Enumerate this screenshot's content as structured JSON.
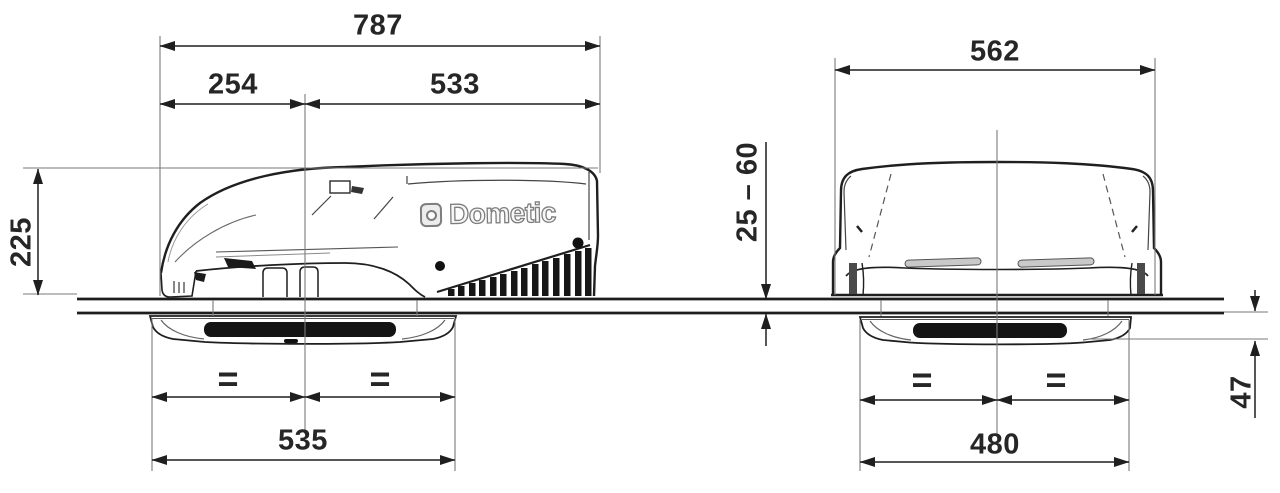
{
  "drawing_title": "rooftop-air-conditioner-dimensional-drawing",
  "logo": {
    "brand": "Dometic"
  },
  "symbols": {
    "equals": "="
  },
  "side_view": {
    "dimensions": {
      "overall_length": "787",
      "front_to_opening_center": "254",
      "opening_center_to_rear": "533",
      "height_above_roof": "225",
      "interior_unit_length": "535"
    }
  },
  "front_view": {
    "dimensions": {
      "overall_width": "562",
      "roof_thickness_range": "25 – 60",
      "interior_unit_width": "480",
      "interior_unit_depth_below_ceiling": "47"
    }
  },
  "colors": {
    "main_line": "#1f1f1f",
    "thin_line": "#7a7a7a",
    "grille_fill": "#161616",
    "text": "#262626",
    "logo_gray": "#7d7d7d"
  }
}
